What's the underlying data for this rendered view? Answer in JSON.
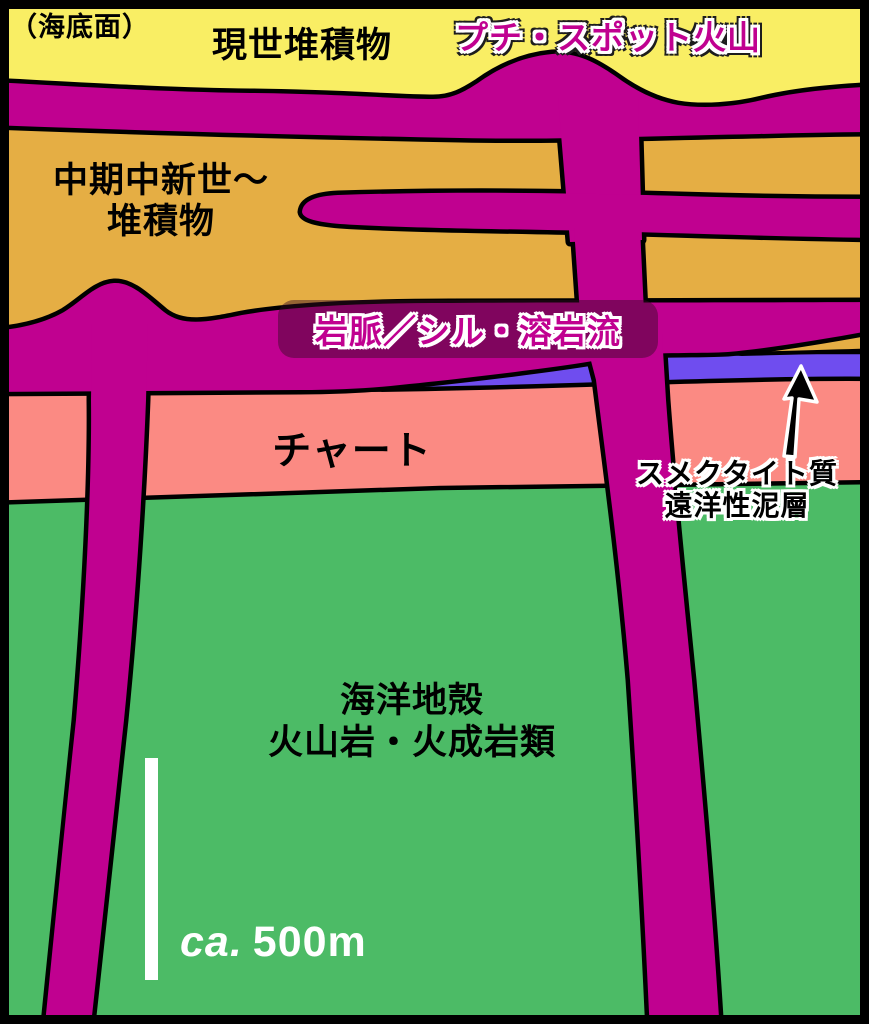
{
  "figure": {
    "type": "geological-cross-section-schematic"
  },
  "labels": {
    "seafloor": "（海底面）",
    "modern_sediments": "現世堆積物",
    "petit_spot_volcano": "プチ・スポット火山",
    "miocene_line1": "中期中新世〜",
    "miocene_line2": "堆積物",
    "dike_sill_lava": "岩脈／シル・溶岩流",
    "chert": "チャート",
    "smectite_line1": "スメクタイト質",
    "smectite_line2": "遠洋性泥層",
    "oceanic_crust_line1": "海洋地殻",
    "oceanic_crust_line2": "火山岩・火成岩類",
    "scale_prefix": "ca.",
    "scale_value": "500m"
  },
  "colors": {
    "modern_sediments_yellow": "#F9EE64",
    "miocene_orange": "#E5AE44",
    "volcanic_magenta": "#C00190",
    "chert_pink": "#FB8A83",
    "oceanic_crust_green": "#4CBB66",
    "smectite_blue": "#6F4DEF",
    "outline_black": "#000000",
    "label_box_bg": "rgba(52,10,34,0.45)",
    "scale_text_white": "#FFFFFF"
  }
}
